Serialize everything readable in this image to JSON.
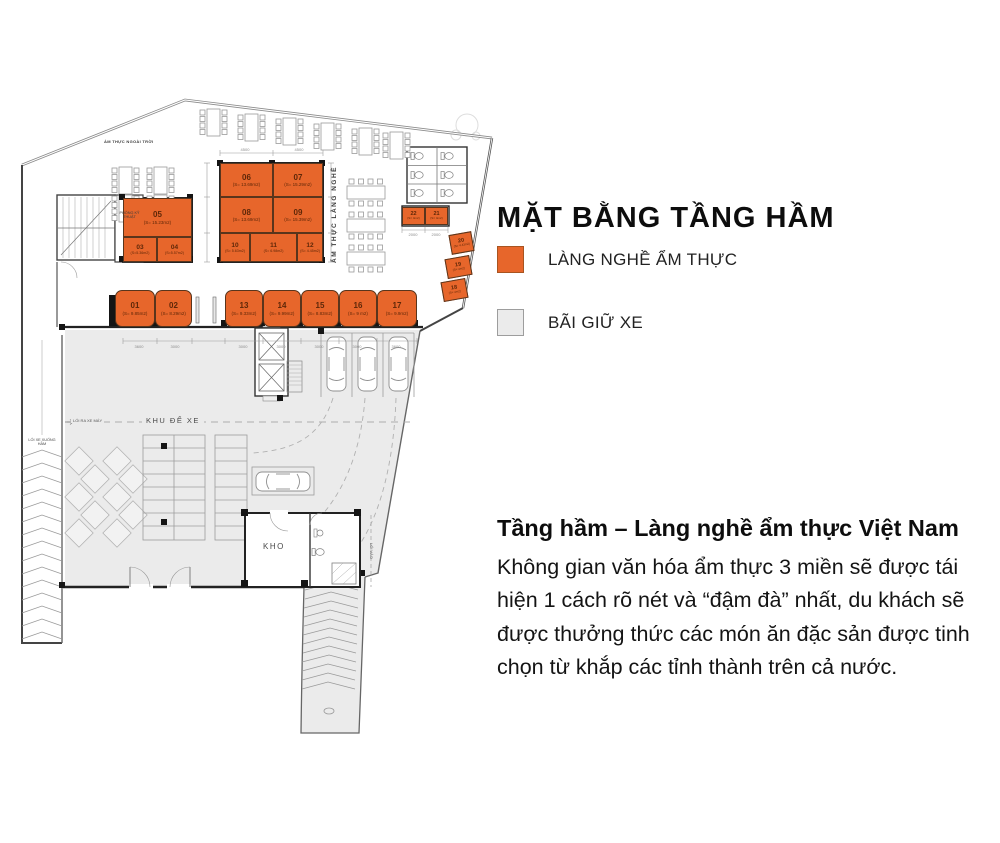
{
  "title": "MẶT BẰNG TẦNG HẦM",
  "colors": {
    "accent_orange": "#E7662B",
    "parking_gray": "#EBEBEB"
  },
  "legend": [
    {
      "label": "LÀNG NGHỀ ẨM THỰC",
      "color": "#E7662B"
    },
    {
      "label": "BÃI GIỮ XE",
      "color": "#EBEBEB"
    }
  ],
  "description": {
    "heading": "Tầng hầm – Làng nghề ẩm thực Việt Nam",
    "body": "Không gian văn hóa ẩm thực 3 miền sẽ được tái hiện 1 cách rõ nét và “đậm đà” nhất, du khách sẽ được thưởng thức các món ăn đặc sản được tinh chọn từ khắp các tỉnh thành trên cả nước."
  },
  "plan": {
    "area_labels": {
      "outdoor_dining": "ẨM THỰC NGOÀI TRỜI",
      "technical_room": "PHÒNG KỸ THUẬT",
      "craft_dining": "ẨM THỰC LÀNG NGHỀ",
      "parking_zone": "KHU ĐỂ XE",
      "motorbike_exit": "LỐI RA XE MÁY",
      "car_ramp": "LỐI XE XUỐNG HẦM",
      "storage": "KHO",
      "entrance": "LỐI VÀO"
    },
    "units": [
      {
        "id": "01",
        "area": "(S= 9.85m2)"
      },
      {
        "id": "02",
        "area": "(S= 8.29m2)"
      },
      {
        "id": "03",
        "area": "(S=5.36m2)"
      },
      {
        "id": "04",
        "area": "(S=5.57m2)"
      },
      {
        "id": "05",
        "area": "(S= 15.23m2)"
      },
      {
        "id": "06",
        "area": "(S= 13.69m2)"
      },
      {
        "id": "07",
        "area": "(S= 15.29m2)"
      },
      {
        "id": "08",
        "area": "(S= 13.69m2)"
      },
      {
        "id": "09",
        "area": "(S= 15.39m2)"
      },
      {
        "id": "10",
        "area": "(S= 5.63m2)"
      },
      {
        "id": "11",
        "area": "(S= 6.98m2)"
      },
      {
        "id": "12",
        "area": "(S= 4.45m2)"
      },
      {
        "id": "13",
        "area": "(S= 9.33m2)"
      },
      {
        "id": "14",
        "area": "(S= 9.99m2)"
      },
      {
        "id": "15",
        "area": "(S= 8.83m2)"
      },
      {
        "id": "16",
        "area": "(S= 9 m2)"
      },
      {
        "id": "17",
        "area": "(S= 9.9m2)"
      },
      {
        "id": "18",
        "area": "(S= 4m2)"
      },
      {
        "id": "19",
        "area": "(S= 4m2)"
      },
      {
        "id": "20",
        "area": "(S= 4.43m2)"
      },
      {
        "id": "21",
        "area": "(S= 4m2)"
      },
      {
        "id": "22",
        "area": "(S= 4m2)"
      }
    ],
    "dimensions": {
      "top": [
        "4500",
        "4500"
      ],
      "bottom": [
        "3600",
        "3000",
        "3000",
        "3000",
        "3000",
        "3000",
        "3600"
      ],
      "right": [
        "2000",
        "2000"
      ]
    }
  }
}
